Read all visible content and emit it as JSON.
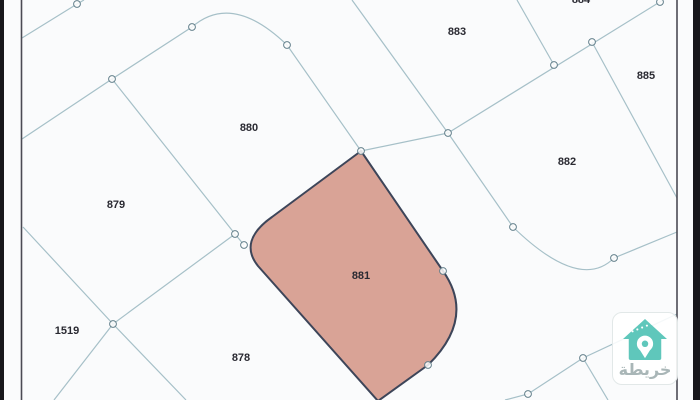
{
  "app_name": "خريطة",
  "selected_parcel": "881",
  "parcels": [
    {
      "id": "880"
    },
    {
      "id": "879"
    },
    {
      "id": "1519"
    },
    {
      "id": "878"
    },
    {
      "id": "881"
    },
    {
      "id": "883"
    },
    {
      "id": "884"
    },
    {
      "id": "885"
    },
    {
      "id": "882"
    }
  ],
  "logo": {
    "text": "خريطة",
    "icon": "house-location-pin-icon"
  },
  "colors": {
    "highlight_fill": "#d9a396",
    "highlight_border": "#3d4559",
    "map_line": "#a6c0c8",
    "vertex_ring": "#64808c",
    "frame_bar": "#17171b",
    "inner_edge": "#4b4b54",
    "label_text": "#2a2a32",
    "logo_teal": "#5fc7bb"
  }
}
